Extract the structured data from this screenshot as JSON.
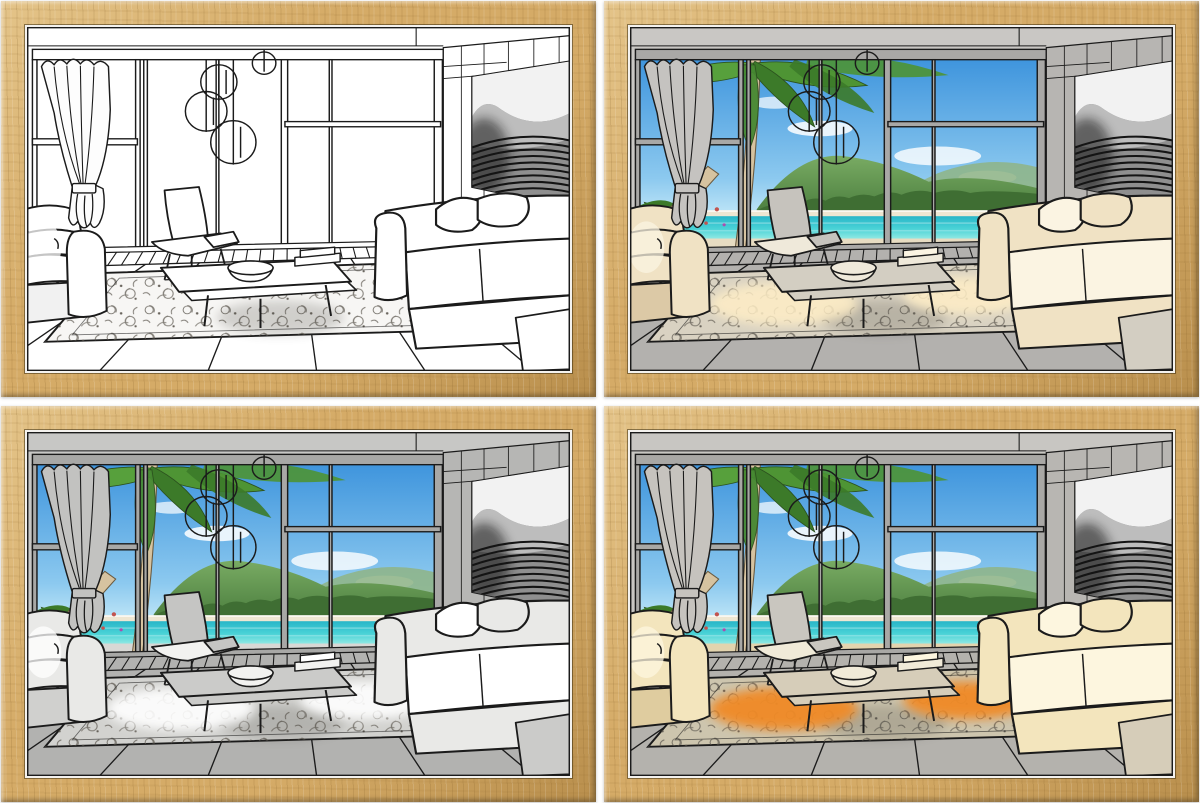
{
  "product": {
    "kind": "framed-art-print-set",
    "scene": "modern living room line drawing with floor-to-ceiling windows, lounge chair, coffee table, sofas, ornate rug, wall art and tropical beach view",
    "frame": {
      "material": "light-oak-wood",
      "wood": "#d5ab67",
      "wood_light": "#e4c489",
      "wood_dark": "#b98f4d",
      "mat_edge": "#f4f2ee"
    },
    "grid": {
      "rows": 2,
      "cols": 2,
      "gap_color": "#ffffff"
    }
  },
  "shared_view": {
    "sky_top": "#3f95dd",
    "sky_bottom": "#c3e8f8",
    "cloud": "#ffffff",
    "hill_dark": "#4d8040",
    "hill_light": "#79ab63",
    "hill_far": "#8fb484",
    "treeline": "#3f6e33",
    "sand": "#eee6d2",
    "sea_dark": "#29b6c8",
    "sea_light": "#8ee8e3",
    "palm_leaf": "#4e9434",
    "palm_leaf_dark": "#3c7a29",
    "palm_trunk": "#d6c3a0",
    "flower_accent": "#c2544f",
    "wall_art": {
      "dark": "#161616",
      "mid": "#9a9a9a",
      "light": "#f2f2f2"
    }
  },
  "panels": [
    {
      "name": "line-art-off",
      "grid_position": "top-left",
      "window_view_visible": false,
      "lighting": "none",
      "colors": {
        "--wall": "#ffffff",
        "--wall2": "#ffffff",
        "--mullion": "#ffffff",
        "--curtain": "#fdfdfd",
        "--sofa": "#ffffff",
        "--sofa-shade": "#f1f1f1",
        "--sofa-hi": "#ffffff",
        "--chair": "#ffffff",
        "--chair-hi": "#ffffff",
        "--table": "#ffffff",
        "--floor": "#ffffff",
        "--deck": "#ffffff",
        "--rug": "#f7f6f4",
        "--glow": "#ffffff",
        "--glow-op": "0",
        "--line": "#1b1b1b"
      }
    },
    {
      "name": "beach-view-warm-room",
      "grid_position": "top-right",
      "window_view_visible": true,
      "lighting": "warm-cream",
      "colors": {
        "--wall": "#c9c7c4",
        "--wall2": "#b7b5b2",
        "--mullion": "#a9a8a6",
        "--curtain": "#c5c3c0",
        "--sofa": "#f0e2c4",
        "--sofa-shade": "#dcc9a6",
        "--sofa-hi": "#fbf4e2",
        "--chair": "#c6c3bd",
        "--chair-hi": "#efe9da",
        "--table": "#d3cec2",
        "--floor": "#b3b1ae",
        "--deck": "#e7dcc2",
        "--rug": "#d9d2c2",
        "--glow": "#ffeec6",
        "--glow-op": "0.85",
        "--line": "#1b1b1b"
      }
    },
    {
      "name": "beach-view-cool-room",
      "grid_position": "bottom-left",
      "window_view_visible": true,
      "lighting": "cool-white",
      "colors": {
        "--wall": "#c7c7c5",
        "--wall2": "#b6b6b4",
        "--mullion": "#a8a8a6",
        "--curtain": "#c2c2c0",
        "--sofa": "#e9e9e7",
        "--sofa-shade": "#d0d0ce",
        "--sofa-hi": "#ffffff",
        "--chair": "#c5c5c3",
        "--chair-hi": "#f2f2f0",
        "--table": "#cbcbc9",
        "--floor": "#b2b2b0",
        "--deck": "#d8d8d5",
        "--rug": "#d2d2cf",
        "--glow": "#ffffff",
        "--glow-op": "0.9",
        "--line": "#1b1b1b"
      }
    },
    {
      "name": "beach-view-sunset-glow",
      "grid_position": "bottom-right",
      "window_view_visible": true,
      "lighting": "warm-orange-glow",
      "colors": {
        "--wall": "#c8c6c2",
        "--wall2": "#b8b6b2",
        "--mullion": "#a9a8a5",
        "--curtain": "#c6c3be",
        "--sofa": "#f3e5bd",
        "--sofa-shade": "#dfcc9f",
        "--sofa-hi": "#fdf6df",
        "--chair": "#c9c6bf",
        "--chair-hi": "#f0ead8",
        "--table": "#d6cdb9",
        "--floor": "#b4b2ad",
        "--deck": "#e3d4ae",
        "--rug": "#cdc5ae",
        "--glow": "#f08a28",
        "--glow-op": "0.95",
        "--line": "#1b1b1b"
      }
    }
  ]
}
